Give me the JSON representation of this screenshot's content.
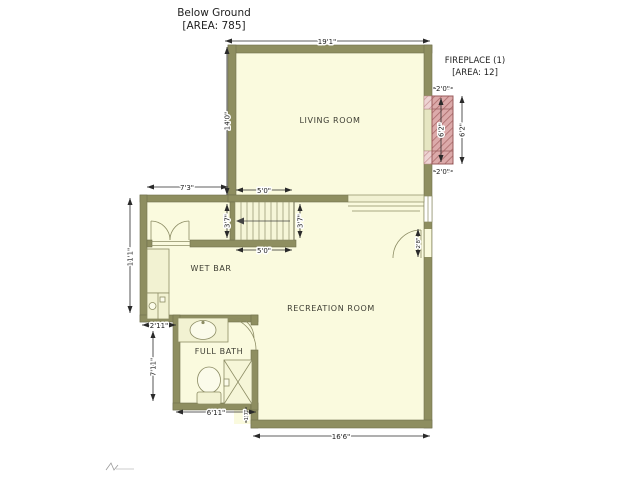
{
  "title": {
    "line1": "Below Ground",
    "line2": "[AREA: 785]"
  },
  "fireplace": {
    "label_line1": "FIREPLACE (1)",
    "label_line2": "[AREA: 12]",
    "top_width": "2'0\"",
    "bottom_width": "2'0\"",
    "inner_height": "6'2\"",
    "outer_height": "6'2\""
  },
  "rooms": {
    "living": "LIVING ROOM",
    "wet_bar": "WET BAR",
    "recreation": "RECREATION ROOM",
    "full_bath": "FULL BATH"
  },
  "dimensions": {
    "top_width": "19'1\"",
    "living_left_height": "14'0\"",
    "upper_left_width": "7'3\"",
    "stairs_width_top": "5'0\"",
    "stairs_width_bottom": "5'0\"",
    "stairs_height_left": "3'7\"",
    "stairs_height_right": "3'7\"",
    "wetbar_left_height": "11'1\"",
    "bath_offset_width": "2'11\"",
    "bath_left_height": "7'11\"",
    "bath_bottom_width": "6'11\"",
    "step_height": "1'7\"",
    "side_door_width": "2'8\"",
    "bottom_width": "16'6\""
  },
  "colors": {
    "wall": "#8e8e60",
    "floor": "#fafade",
    "fireplace": "#dcaaaa",
    "dimension_text": "#1c1c1c"
  }
}
